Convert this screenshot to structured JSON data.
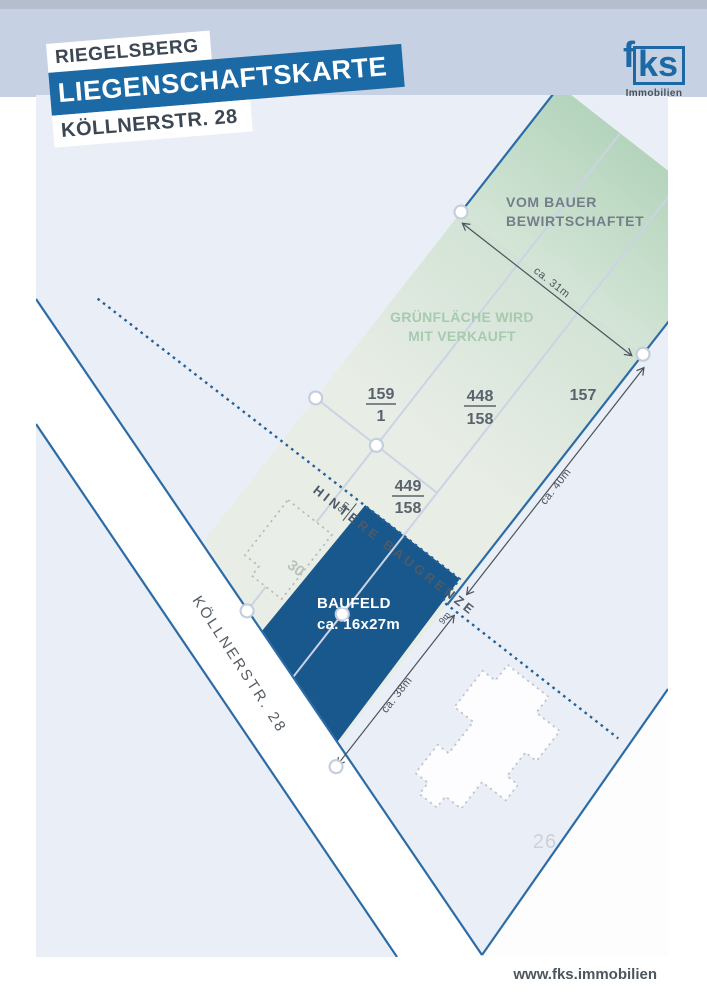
{
  "header": {
    "location": "RIEGELSBERG",
    "title": "LIEGENSCHAFTSKARTE",
    "street": "KÖLLNERSTR. 28"
  },
  "logo": {
    "f": "f",
    "ks": "ks",
    "subtitle": "Immobilien"
  },
  "map": {
    "annotations": {
      "vom_bauer": {
        "line1": "VOM BAUER",
        "line2": "BEWIRTSCHAFTET"
      },
      "gruenflaeche": {
        "line1": "GRÜNFLÄCHE WIRD",
        "line2": "MIT VERKAUFT"
      },
      "baugrenze": "HINTERE BAUGRENZE",
      "baufeld": {
        "line1": "BAUFELD",
        "line2": "ca. 16x27m"
      },
      "street_label": "KÖLLNERSTR. 28"
    },
    "parcels": [
      {
        "num": "159",
        "sub": "1"
      },
      {
        "num": "448",
        "sub": "158"
      },
      {
        "num": "157",
        "sub": ""
      },
      {
        "num": "449",
        "sub": "158"
      }
    ],
    "houses": {
      "h30": "30",
      "h26": "26"
    },
    "dimensions": {
      "d31": "ca. 31m",
      "d40": "ca. 40m",
      "d38": "ca. 38m",
      "d9a": "9m",
      "d9b": "9m"
    },
    "colors": {
      "accent_blue": "#1b6aa5",
      "baufeld_fill": "#18588c",
      "map_line_blue": "#2c6ca6",
      "green_band": "#b8d6bf",
      "pale_parcel": "#e8ede6",
      "pale_blue": "#eaeef6",
      "header_blue": "#c6d2e3"
    }
  },
  "footer": {
    "url": "www.fks.immobilien"
  }
}
